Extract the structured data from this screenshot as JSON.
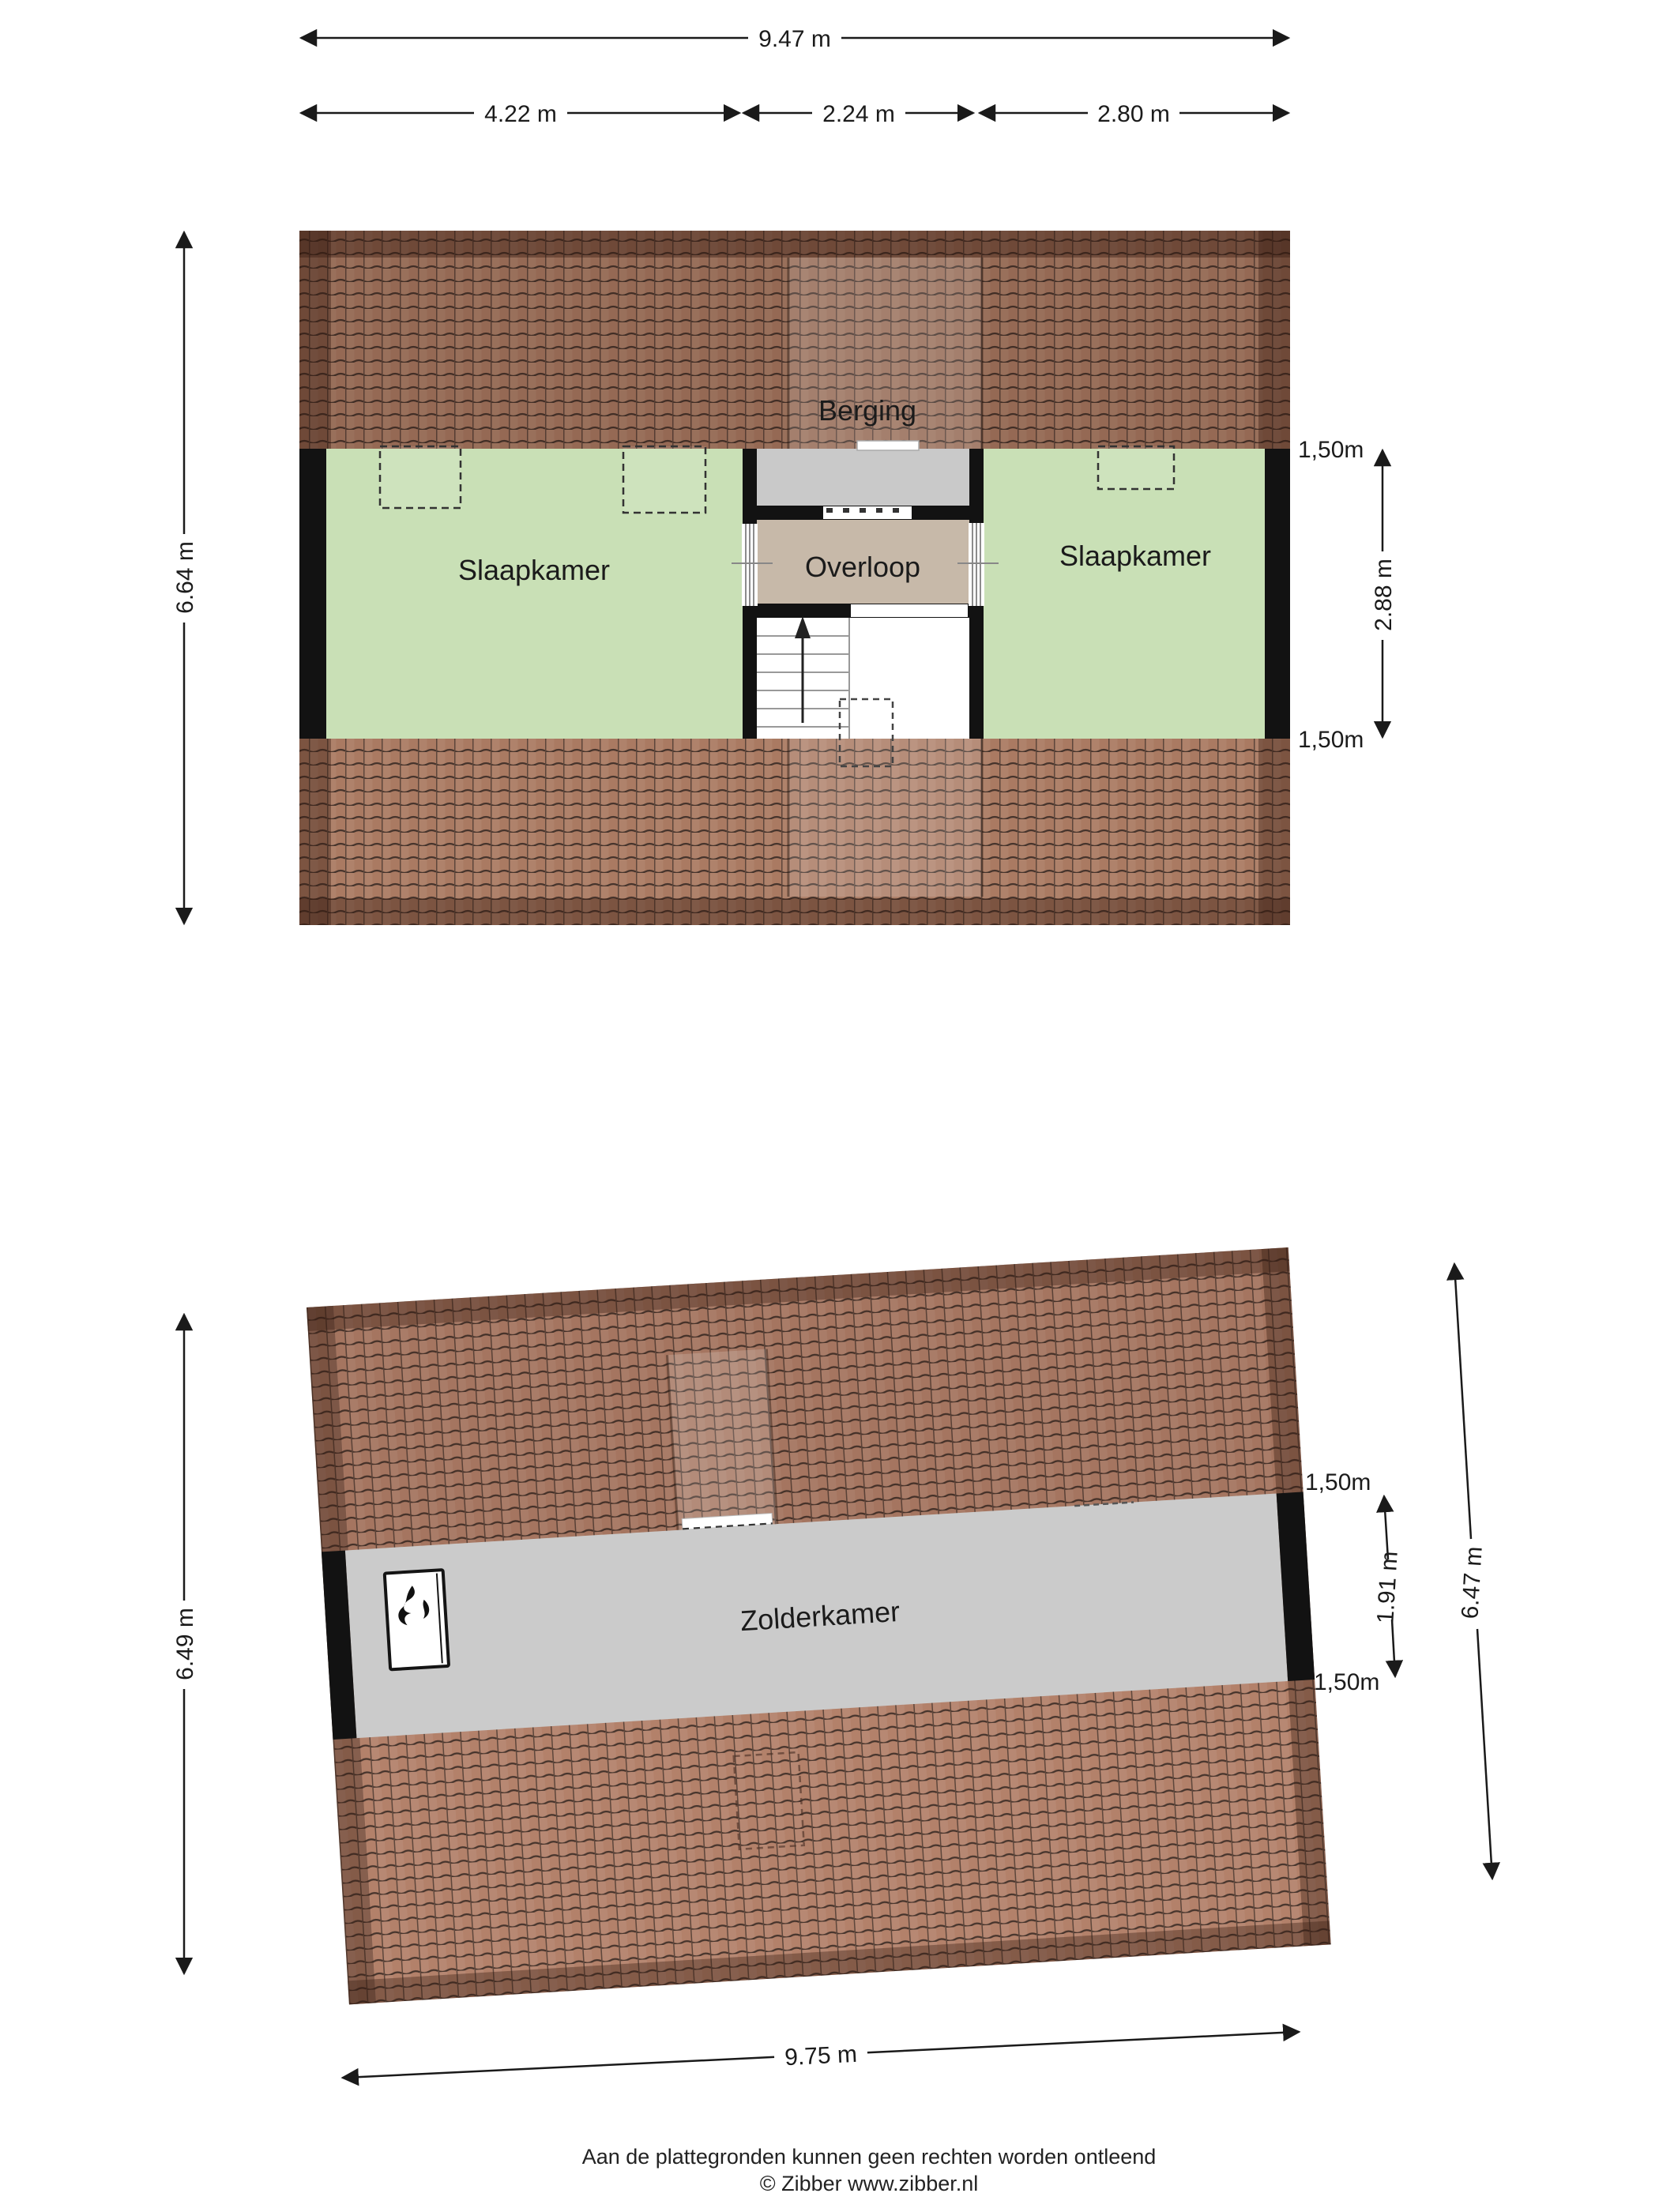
{
  "colors": {
    "room_green": "#c9e0b6",
    "hall_beige": "#c7b9a9",
    "storage_grey": "#c9c9c9",
    "loft_grey": "#cbcbcb",
    "roof_brown": "#aa7a62",
    "roof_brown_light": "#b3816a",
    "wall_black": "#121212"
  },
  "plan_attic": {
    "room_left": "Slaapkamer",
    "room_right": "Slaapkamer",
    "room_storage": "Berging",
    "room_hall": "Overloop",
    "dim_width_total": "9.47 m",
    "dim_width_left": "4.22 m",
    "dim_width_center": "2.24 m",
    "dim_width_right": "2.80 m",
    "dim_height_total": "6.64 m",
    "dim_room_depth": "2.88 m",
    "knee_wall_top": "1,50m",
    "knee_wall_bottom": "1,50m"
  },
  "plan_loft": {
    "room": "Zolderkamer",
    "dim_width_total": "9.75 m",
    "dim_height_left": "6.49 m",
    "dim_height_right": "6.47 m",
    "dim_room_depth": "1.91 m",
    "knee_wall_top": "1,50m",
    "knee_wall_bottom": "1,50m"
  },
  "footer": {
    "line1": "Aan de plattegronden kunnen geen rechten worden ontleend",
    "line2": "© Zibber www.zibber.nl"
  }
}
